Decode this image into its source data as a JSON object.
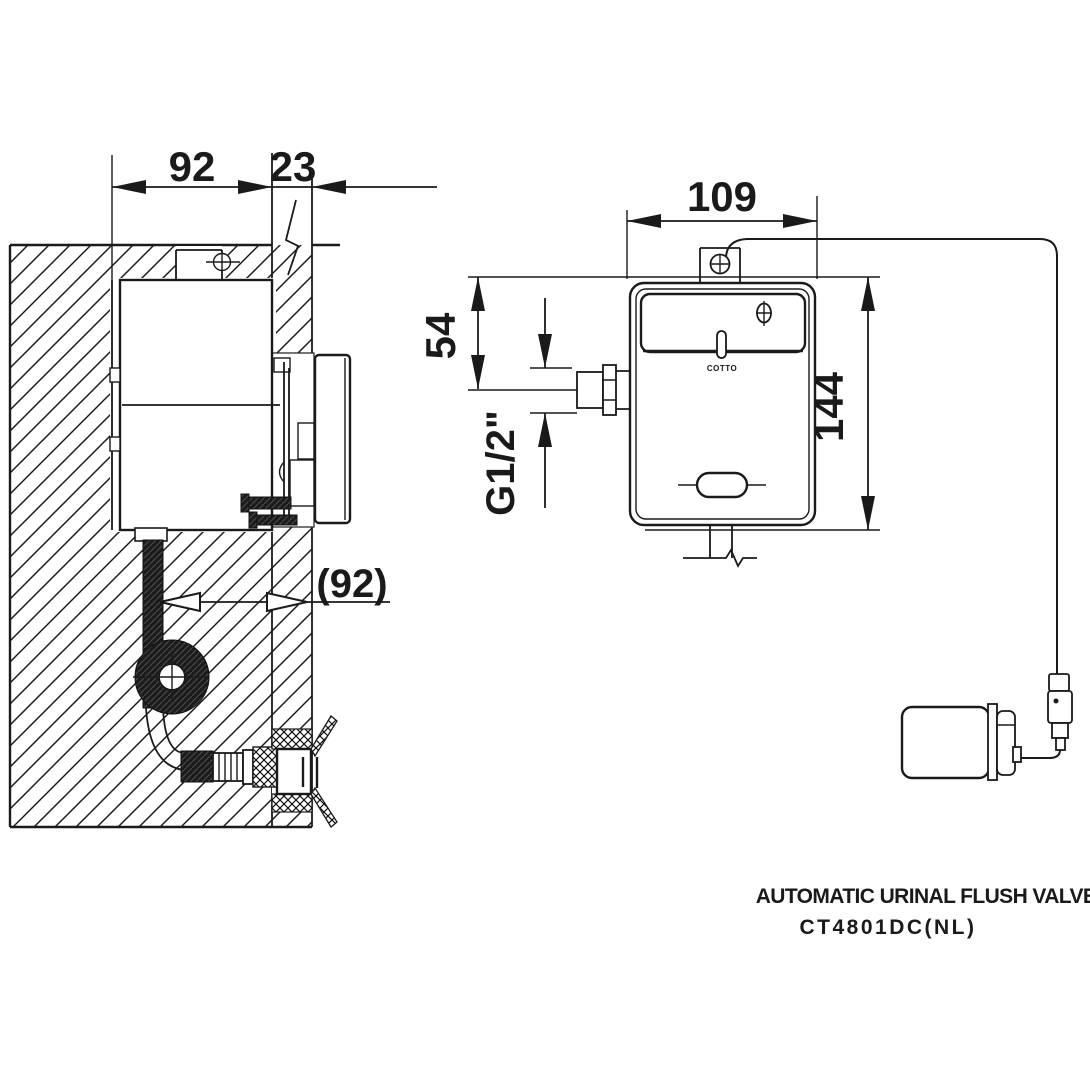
{
  "drawing": {
    "side_view": {
      "dim_recess_width": "92",
      "dim_wall_thickness": "23",
      "dim_recess_ref": "(92)"
    },
    "front_view": {
      "dim_body_width": "109",
      "dim_inlet_offset": "54",
      "dim_inlet_thread": "G1/2\"",
      "dim_body_height": "144",
      "brand": "COTTO"
    },
    "caption": {
      "product_name": "AUTOMATIC URINAL FLUSH VALVE",
      "model": "CT4801DC(NL)"
    },
    "colors": {
      "line": "#1a1a1a",
      "background": "#ffffff"
    }
  }
}
